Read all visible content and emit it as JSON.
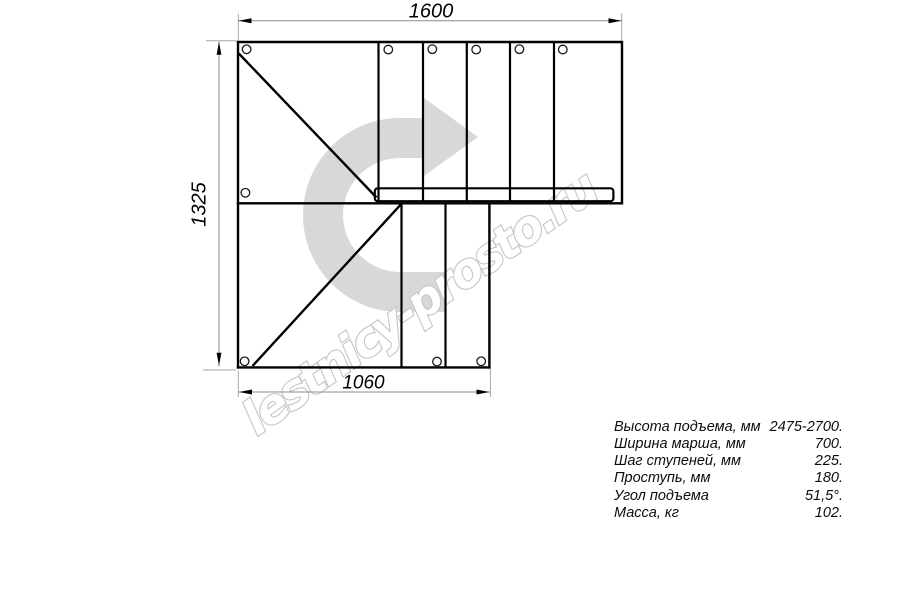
{
  "page": {
    "background": "#ffffff"
  },
  "drawing": {
    "type": "staircase-plan-top-view",
    "dimensions": {
      "top_width_mm": "1600",
      "left_height_mm": "1325",
      "bottom_width_mm": "1060"
    },
    "direction_arrow": "u-turn-arrow-pointing-right",
    "colors": {
      "outline": "#000000",
      "dimension_line": "#8c8c8c",
      "extension_line": "#a6a6a6",
      "watermark_arrow": "#d8d8d8",
      "watermark_text_outline": "#c5c5c5"
    }
  },
  "watermark": {
    "text": "lestnicy-prosto.ru"
  },
  "specs": {
    "rows": [
      {
        "label": "Высота подъема, мм",
        "value": "2475-2700."
      },
      {
        "label": "Ширина марша, мм",
        "value": "700."
      },
      {
        "label": "Шаг ступеней, мм",
        "value": "225."
      },
      {
        "label": "Проступь, мм",
        "value": "180."
      },
      {
        "label": "Угол подъема",
        "value": "51,5°."
      },
      {
        "label": "Масса, кг",
        "value": "102."
      }
    ]
  }
}
